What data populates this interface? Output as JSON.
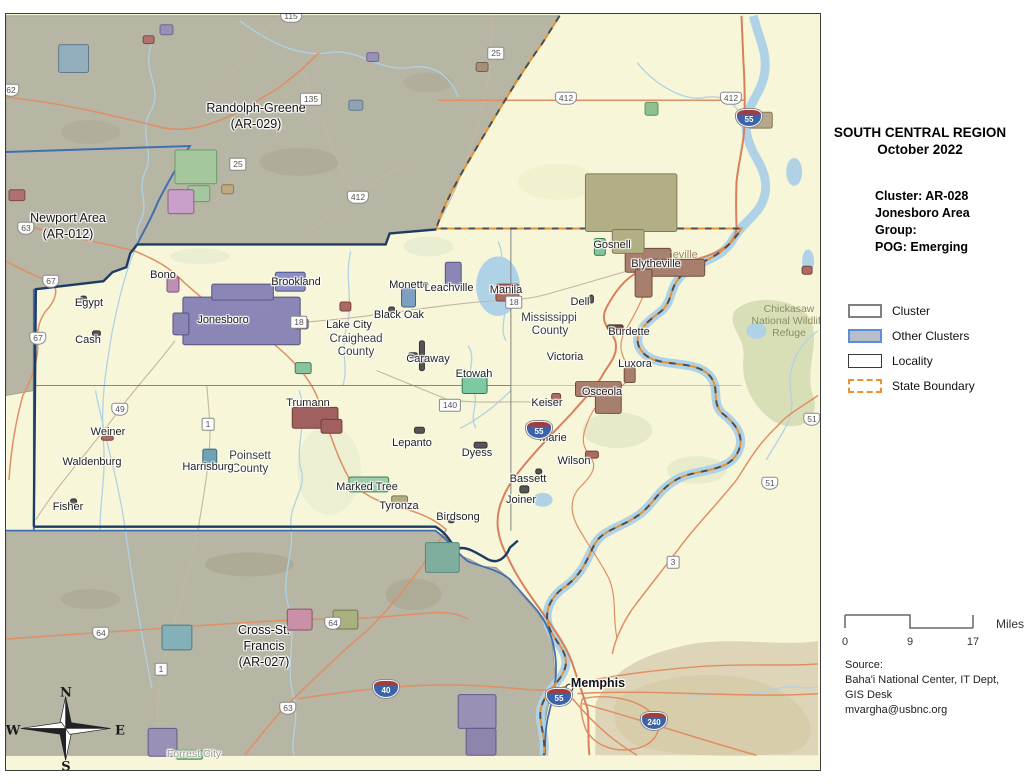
{
  "panel": {
    "title_line1": "SOUTH CENTRAL REGION",
    "title_line2": "October 2022",
    "cluster_lines": [
      "Cluster: AR-028",
      "Jonesboro Area",
      "Group:",
      "POG: Emerging"
    ],
    "legend": {
      "items": [
        {
          "label": "Cluster"
        },
        {
          "label": "Other Clusters"
        },
        {
          "label": "Locality"
        },
        {
          "label": "State Boundary"
        }
      ]
    },
    "scale": {
      "ticks": [
        "0",
        "9",
        "17"
      ],
      "unit": "Miles"
    },
    "source_lines": [
      "Source:",
      "Baha'i National Center, IT Dept,",
      "GIS Desk",
      "mvargha@usbnc.org"
    ]
  },
  "colors": {
    "cluster_fill": "#f7f6d8",
    "other_cluster_fill": "#b7b5a4",
    "cluster_border": "#1d3c63",
    "other_cluster_border": "#3f6fb2",
    "state_boundary_orange": "#e8932e",
    "water": "#afd2e6",
    "road_orange": "#e08e63",
    "interstate_blue": "#3c63a8",
    "interstate_red": "#a33c3c"
  },
  "map": {
    "offset": {
      "x": 5,
      "y": 13
    },
    "labels": [
      {
        "text": "Randolph-Greene",
        "x": 255,
        "y": 107,
        "cls": "region"
      },
      {
        "text": "(AR-029)",
        "x": 255,
        "y": 123,
        "cls": "region"
      },
      {
        "text": "Newport Area",
        "x": 67,
        "y": 217,
        "cls": "region"
      },
      {
        "text": "(AR-012)",
        "x": 67,
        "y": 233,
        "cls": "region"
      },
      {
        "text": "Cross-St.",
        "x": 263,
        "y": 629,
        "cls": "region"
      },
      {
        "text": "Francis",
        "x": 263,
        "y": 645,
        "cls": "region"
      },
      {
        "text": "(AR-027)",
        "x": 263,
        "y": 661,
        "cls": "region"
      },
      {
        "text": "Chickasaw",
        "x": 788,
        "y": 308,
        "cls": "refuge"
      },
      {
        "text": "National Wildlife",
        "x": 788,
        "y": 320,
        "cls": "refuge"
      },
      {
        "text": "Refuge",
        "x": 788,
        "y": 332,
        "cls": "refuge"
      },
      {
        "text": "Craighead",
        "x": 355,
        "y": 338,
        "cls": "county"
      },
      {
        "text": "County",
        "x": 355,
        "y": 351,
        "cls": "county"
      },
      {
        "text": "Mississippi",
        "x": 548,
        "y": 317,
        "cls": "county"
      },
      {
        "text": "County",
        "x": 549,
        "y": 330,
        "cls": "county"
      },
      {
        "text": "Poinsett",
        "x": 249,
        "y": 455,
        "cls": "county"
      },
      {
        "text": "County",
        "x": 249,
        "y": 468,
        "cls": "county"
      },
      {
        "text": "Jonesboro",
        "x": 242,
        "y": 306,
        "cls": "ghost-purple"
      },
      {
        "text": "Blytheville",
        "x": 672,
        "y": 254,
        "cls": "ghost-brown"
      },
      {
        "text": "Forrest City",
        "x": 193,
        "y": 753,
        "cls": "ghost-gray"
      },
      {
        "text": "Bono",
        "x": 162,
        "y": 274,
        "cls": "town"
      },
      {
        "text": "Brookland",
        "x": 295,
        "y": 281,
        "cls": "town"
      },
      {
        "text": "Egypt",
        "x": 88,
        "y": 302,
        "cls": "town"
      },
      {
        "text": "Cash",
        "x": 87,
        "y": 339,
        "cls": "town"
      },
      {
        "text": "Jonesboro",
        "x": 222,
        "y": 319,
        "cls": "town"
      },
      {
        "text": "Lake City",
        "x": 348,
        "y": 324,
        "cls": "town"
      },
      {
        "text": "Black Oak",
        "x": 398,
        "y": 314,
        "cls": "town"
      },
      {
        "text": "Caraway",
        "x": 427,
        "y": 358,
        "cls": "town"
      },
      {
        "text": "Monette",
        "x": 408,
        "y": 284,
        "cls": "town"
      },
      {
        "text": "Leachville",
        "x": 448,
        "y": 287,
        "cls": "town"
      },
      {
        "text": "Manila",
        "x": 505,
        "y": 289,
        "cls": "town"
      },
      {
        "text": "Etowah",
        "x": 473,
        "y": 373,
        "cls": "town"
      },
      {
        "text": "Dell",
        "x": 579,
        "y": 301,
        "cls": "town"
      },
      {
        "text": "Gosnell",
        "x": 611,
        "y": 244,
        "cls": "town"
      },
      {
        "text": "Blytheville",
        "x": 655,
        "y": 263,
        "cls": "town"
      },
      {
        "text": "Burdette",
        "x": 628,
        "y": 331,
        "cls": "town"
      },
      {
        "text": "Victoria",
        "x": 564,
        "y": 356,
        "cls": "town"
      },
      {
        "text": "Luxora",
        "x": 634,
        "y": 363,
        "cls": "town"
      },
      {
        "text": "Osceola",
        "x": 601,
        "y": 391,
        "cls": "town"
      },
      {
        "text": "Keiser",
        "x": 546,
        "y": 402,
        "cls": "town"
      },
      {
        "text": "Marie",
        "x": 552,
        "y": 437,
        "cls": "town"
      },
      {
        "text": "Wilson",
        "x": 573,
        "y": 460,
        "cls": "town"
      },
      {
        "text": "Bassett",
        "x": 527,
        "y": 478,
        "cls": "town"
      },
      {
        "text": "Joiner",
        "x": 520,
        "y": 499,
        "cls": "town"
      },
      {
        "text": "Birdsong",
        "x": 457,
        "y": 516,
        "cls": "town"
      },
      {
        "text": "Dyess",
        "x": 476,
        "y": 452,
        "cls": "town"
      },
      {
        "text": "Lepanto",
        "x": 411,
        "y": 442,
        "cls": "town"
      },
      {
        "text": "Tyronza",
        "x": 398,
        "y": 505,
        "cls": "town"
      },
      {
        "text": "Marked Tree",
        "x": 366,
        "y": 486,
        "cls": "town"
      },
      {
        "text": "Trumann",
        "x": 307,
        "y": 402,
        "cls": "town"
      },
      {
        "text": "Harrisburg",
        "x": 207,
        "y": 466,
        "cls": "town"
      },
      {
        "text": "Weiner",
        "x": 107,
        "y": 431,
        "cls": "town"
      },
      {
        "text": "Waldenburg",
        "x": 91,
        "y": 461,
        "cls": "town"
      },
      {
        "text": "Fisher",
        "x": 67,
        "y": 506,
        "cls": "town"
      },
      {
        "text": "Memphis",
        "x": 597,
        "y": 682,
        "cls": "city"
      },
      {
        "text": "N",
        "x": 65,
        "y": 692,
        "cls": "compass"
      },
      {
        "text": "E",
        "x": 119,
        "y": 730,
        "cls": "compass"
      },
      {
        "text": "S",
        "x": 65,
        "y": 766,
        "cls": "compass"
      },
      {
        "text": "W",
        "x": 12,
        "y": 730,
        "cls": "compass"
      }
    ],
    "shields": [
      {
        "type": "us",
        "label": "115",
        "x": 290,
        "y": 15
      },
      {
        "type": "us",
        "label": "62",
        "x": 10,
        "y": 89
      },
      {
        "type": "state",
        "label": "135",
        "x": 310,
        "y": 98
      },
      {
        "type": "state",
        "label": "25",
        "x": 495,
        "y": 52
      },
      {
        "type": "state",
        "label": "25",
        "x": 237,
        "y": 163
      },
      {
        "type": "us",
        "label": "412",
        "x": 565,
        "y": 97
      },
      {
        "type": "us",
        "label": "412",
        "x": 730,
        "y": 97
      },
      {
        "type": "us",
        "label": "412",
        "x": 357,
        "y": 196
      },
      {
        "type": "interstate",
        "label": "55",
        "x": 748,
        "y": 117
      },
      {
        "type": "us",
        "label": "63",
        "x": 25,
        "y": 227
      },
      {
        "type": "us",
        "label": "67",
        "x": 50,
        "y": 280
      },
      {
        "type": "us",
        "label": "67",
        "x": 37,
        "y": 337
      },
      {
        "type": "state",
        "label": "18",
        "x": 298,
        "y": 321
      },
      {
        "type": "state",
        "label": "18",
        "x": 513,
        "y": 301
      },
      {
        "type": "state",
        "label": "140",
        "x": 449,
        "y": 404
      },
      {
        "type": "us",
        "label": "49",
        "x": 119,
        "y": 408
      },
      {
        "type": "state",
        "label": "1",
        "x": 207,
        "y": 423
      },
      {
        "type": "interstate",
        "label": "55",
        "x": 538,
        "y": 429
      },
      {
        "type": "us",
        "label": "51",
        "x": 811,
        "y": 418
      },
      {
        "type": "us",
        "label": "51",
        "x": 769,
        "y": 482
      },
      {
        "type": "state",
        "label": "3",
        "x": 672,
        "y": 561
      },
      {
        "type": "us",
        "label": "64",
        "x": 100,
        "y": 632
      },
      {
        "type": "us",
        "label": "64",
        "x": 332,
        "y": 622
      },
      {
        "type": "state",
        "label": "1",
        "x": 160,
        "y": 668
      },
      {
        "type": "us",
        "label": "63",
        "x": 287,
        "y": 707
      },
      {
        "type": "interstate",
        "label": "40",
        "x": 385,
        "y": 688
      },
      {
        "type": "interstate",
        "label": "55",
        "x": 558,
        "y": 696
      },
      {
        "type": "interstate",
        "label": "240",
        "x": 653,
        "y": 720
      }
    ],
    "towns": [
      {
        "x": 183,
        "y": 296,
        "w": 118,
        "h": 48,
        "f": "#8a86b5",
        "s": "#57527f"
      },
      {
        "x": 212,
        "y": 283,
        "w": 62,
        "h": 16,
        "f": "#8a86b5",
        "s": "#57527f"
      },
      {
        "x": 173,
        "y": 312,
        "w": 16,
        "h": 22,
        "f": "#8a86b5",
        "s": "#57527f"
      },
      {
        "x": 295,
        "y": 318,
        "w": 14,
        "h": 10,
        "f": "#8a86b5",
        "s": "#57527f"
      },
      {
        "x": 276,
        "y": 271,
        "w": 30,
        "h": 19,
        "f": "#8a8fc5",
        "s": "#4f4f8f"
      },
      {
        "x": 167,
        "y": 276,
        "w": 12,
        "h": 15,
        "f": "#bd8fb3",
        "s": "#7a5276"
      },
      {
        "x": 296,
        "y": 362,
        "w": 16,
        "h": 11,
        "f": "#88c49b",
        "s": "#3f7a52"
      },
      {
        "x": 403,
        "y": 287,
        "w": 14,
        "h": 19,
        "f": "#7d9fc0",
        "s": "#44607f"
      },
      {
        "x": 447,
        "y": 261,
        "w": 16,
        "h": 23,
        "f": "#8a86b5",
        "s": "#57527f"
      },
      {
        "x": 498,
        "y": 283,
        "w": 23,
        "h": 17,
        "f": "#ad6a64",
        "s": "#74423c"
      },
      {
        "x": 341,
        "y": 301,
        "w": 11,
        "h": 9,
        "f": "#ad6a64",
        "s": "#74423c"
      },
      {
        "x": 421,
        "y": 340,
        "w": 5,
        "h": 30,
        "f": "#555555",
        "s": "#333333"
      },
      {
        "x": 410,
        "y": 352,
        "w": 9,
        "h": 5,
        "f": "#555555",
        "s": "#333333"
      },
      {
        "x": 390,
        "y": 306,
        "w": 6,
        "h": 5,
        "f": "#555555",
        "s": "#333333"
      },
      {
        "x": 464,
        "y": 376,
        "w": 25,
        "h": 17,
        "f": "#7cc9a2",
        "s": "#2f7a55"
      },
      {
        "x": 597,
        "y": 237,
        "w": 11,
        "h": 17,
        "f": "#88c49b",
        "s": "#3f7a52"
      },
      {
        "x": 628,
        "y": 247,
        "w": 46,
        "h": 24,
        "f": "#a87e6d",
        "s": "#6e4c3e"
      },
      {
        "x": 652,
        "y": 258,
        "w": 56,
        "h": 17,
        "f": "#a87e6d",
        "s": "#6e4c3e"
      },
      {
        "x": 638,
        "y": 268,
        "w": 17,
        "h": 28,
        "f": "#a87e6d",
        "s": "#6e4c3e"
      },
      {
        "x": 610,
        "y": 324,
        "w": 16,
        "h": 5,
        "f": "#6b4a3d",
        "s": "#4a3328"
      },
      {
        "x": 627,
        "y": 367,
        "w": 11,
        "h": 15,
        "f": "#a87e6d",
        "s": "#6e4c3e"
      },
      {
        "x": 578,
        "y": 381,
        "w": 46,
        "h": 15,
        "f": "#a87e6d",
        "s": "#6e4c3e"
      },
      {
        "x": 598,
        "y": 389,
        "w": 26,
        "h": 24,
        "f": "#a87e6d",
        "s": "#6e4c3e"
      },
      {
        "x": 554,
        "y": 393,
        "w": 9,
        "h": 7,
        "f": "#ad6a64",
        "s": "#74423c"
      },
      {
        "x": 543,
        "y": 427,
        "w": 8,
        "h": 5,
        "f": "#6b4a3d",
        "s": "#4a3328"
      },
      {
        "x": 476,
        "y": 442,
        "w": 13,
        "h": 6,
        "f": "#555555",
        "s": "#333333"
      },
      {
        "x": 588,
        "y": 451,
        "w": 13,
        "h": 7,
        "f": "#ad6a64",
        "s": "#74423c"
      },
      {
        "x": 522,
        "y": 486,
        "w": 9,
        "h": 7,
        "f": "#555555",
        "s": "#333333"
      },
      {
        "x": 538,
        "y": 469,
        "w": 6,
        "h": 5,
        "f": "#555555",
        "s": "#333333"
      },
      {
        "x": 293,
        "y": 407,
        "w": 46,
        "h": 21,
        "f": "#a06060",
        "s": "#6e3c3c"
      },
      {
        "x": 322,
        "y": 419,
        "w": 21,
        "h": 14,
        "f": "#a06060",
        "s": "#6e3c3c"
      },
      {
        "x": 350,
        "y": 477,
        "w": 40,
        "h": 15,
        "f": "#9fcfae",
        "s": "#3f7a52"
      },
      {
        "x": 393,
        "y": 496,
        "w": 16,
        "h": 7,
        "f": "#b2ae84",
        "s": "#7a7652"
      },
      {
        "x": 203,
        "y": 449,
        "w": 14,
        "h": 17,
        "f": "#6fa3b5",
        "s": "#3f6b7a"
      },
      {
        "x": 416,
        "y": 427,
        "w": 10,
        "h": 6,
        "f": "#555555",
        "s": "#333333"
      },
      {
        "x": 450,
        "y": 519,
        "w": 6,
        "h": 4,
        "f": "#555555",
        "s": "#333333"
      },
      {
        "x": 101,
        "y": 436,
        "w": 12,
        "h": 4,
        "f": "#ad6a64",
        "s": "#74423c"
      },
      {
        "x": 80,
        "y": 295,
        "w": 6,
        "h": 7,
        "f": "#555555",
        "s": "#333333"
      },
      {
        "x": 92,
        "y": 330,
        "w": 8,
        "h": 5,
        "f": "#555555",
        "s": "#333333"
      },
      {
        "x": 70,
        "y": 499,
        "w": 6,
        "h": 5,
        "f": "#555555",
        "s": "#333333"
      },
      {
        "x": 592,
        "y": 294,
        "w": 4,
        "h": 8,
        "f": "#555555",
        "s": "#333333"
      },
      {
        "x": 58,
        "y": 42,
        "w": 30,
        "h": 28,
        "f": "#93aebd",
        "s": "#5f7a8a"
      },
      {
        "x": 160,
        "y": 22,
        "w": 13,
        "h": 10,
        "f": "#9a8fb5",
        "s": "#6a6a8f"
      },
      {
        "x": 143,
        "y": 33,
        "w": 11,
        "h": 8,
        "f": "#b07070",
        "s": "#7a4a4a"
      },
      {
        "x": 175,
        "y": 148,
        "w": 42,
        "h": 34,
        "f": "#a4c79e",
        "s": "#6a9a6a"
      },
      {
        "x": 188,
        "y": 184,
        "w": 22,
        "h": 16,
        "f": "#a4c79e",
        "s": "#6a9a6a"
      },
      {
        "x": 168,
        "y": 188,
        "w": 26,
        "h": 24,
        "f": "#c9a0c9",
        "s": "#8a5f8a"
      },
      {
        "x": 588,
        "y": 172,
        "w": 92,
        "h": 58,
        "f": "#b2ae85",
        "s": "#807c55"
      },
      {
        "x": 615,
        "y": 228,
        "w": 32,
        "h": 24,
        "f": "#b2ae85",
        "s": "#807c55"
      },
      {
        "x": 648,
        "y": 100,
        "w": 13,
        "h": 13,
        "f": "#8fc08f",
        "s": "#5f8f5f"
      },
      {
        "x": 752,
        "y": 110,
        "w": 24,
        "h": 16,
        "f": "#b5a88a",
        "s": "#857a5a"
      },
      {
        "x": 8,
        "y": 188,
        "w": 16,
        "h": 11,
        "f": "#b07070",
        "s": "#7a4a4a"
      },
      {
        "x": 368,
        "y": 50,
        "w": 12,
        "h": 9,
        "f": "#9a8fb5",
        "s": "#6a6a8f"
      },
      {
        "x": 350,
        "y": 98,
        "w": 14,
        "h": 10,
        "f": "#8fa3b5",
        "s": "#5f7a8a"
      },
      {
        "x": 222,
        "y": 183,
        "w": 12,
        "h": 9,
        "f": "#c0a882",
        "s": "#8a7a55"
      },
      {
        "x": 478,
        "y": 60,
        "w": 12,
        "h": 9,
        "f": "#a58f7a",
        "s": "#75604a"
      },
      {
        "x": 162,
        "y": 626,
        "w": 30,
        "h": 25,
        "f": "#84b0b8",
        "s": "#4f7a85"
      },
      {
        "x": 288,
        "y": 610,
        "w": 25,
        "h": 21,
        "f": "#c990a8",
        "s": "#8a5566"
      },
      {
        "x": 334,
        "y": 611,
        "w": 25,
        "h": 19,
        "f": "#aab080",
        "s": "#757a50"
      },
      {
        "x": 148,
        "y": 730,
        "w": 29,
        "h": 28,
        "f": "#9a8fb5",
        "s": "#5f5a8a"
      },
      {
        "x": 176,
        "y": 752,
        "w": 27,
        "h": 9,
        "f": "#88bb88",
        "s": "#558855"
      },
      {
        "x": 460,
        "y": 696,
        "w": 38,
        "h": 34,
        "f": "#9a8fb5",
        "s": "#5f5a8a"
      },
      {
        "x": 468,
        "y": 730,
        "w": 30,
        "h": 27,
        "f": "#8f84ac",
        "s": "#5f5a8a"
      },
      {
        "x": 427,
        "y": 543,
        "w": 34,
        "h": 30,
        "f": "#7fae9e",
        "s": "#55897a"
      },
      {
        "x": 806,
        "y": 265,
        "w": 10,
        "h": 8,
        "f": "#b06a64",
        "s": "#74423c"
      }
    ]
  }
}
